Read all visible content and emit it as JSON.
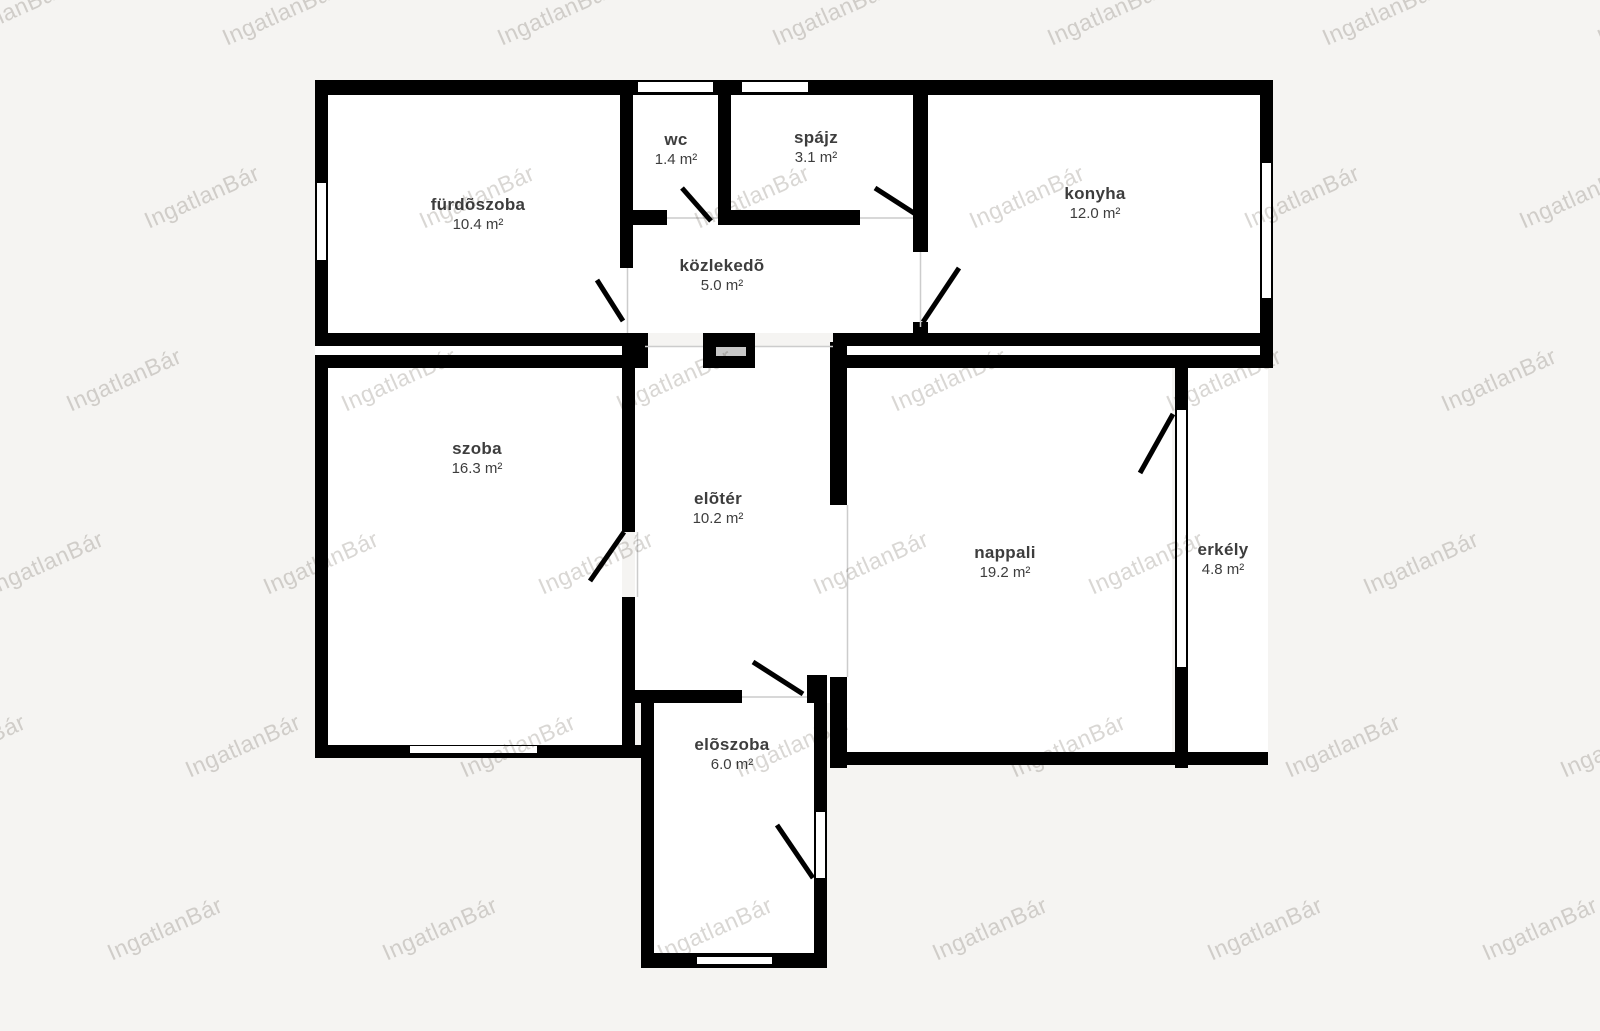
{
  "title": "alaprajz",
  "watermark": {
    "text": "IngatlanBár"
  },
  "colors": {
    "background": "#f5f4f2",
    "room": "#ffffff",
    "wall": "#000000",
    "hairline": "#cccccc",
    "label": "#3d3d3d",
    "watermark": "#d9d7d4",
    "shaft_slot": "#c8c8c8"
  },
  "rooms": [
    {
      "id": "furdoszoba",
      "name": "fürdõszoba",
      "area": "10.4 m²"
    },
    {
      "id": "wc",
      "name": "wc",
      "area": "1.4 m²"
    },
    {
      "id": "spajz",
      "name": "spájz",
      "area": "3.1 m²"
    },
    {
      "id": "konyha",
      "name": "konyha",
      "area": "12.0 m²"
    },
    {
      "id": "kozlekedo",
      "name": "közlekedõ",
      "area": "5.0 m²"
    },
    {
      "id": "szoba",
      "name": "szoba",
      "area": "16.3 m²"
    },
    {
      "id": "eloter",
      "name": "elõtér",
      "area": "10.2 m²"
    },
    {
      "id": "nappali",
      "name": "nappali",
      "area": "19.2 m²"
    },
    {
      "id": "erkely",
      "name": "erkély",
      "area": "4.8 m²"
    },
    {
      "id": "eloszoba",
      "name": "elõszoba",
      "area": "6.0 m²"
    }
  ]
}
